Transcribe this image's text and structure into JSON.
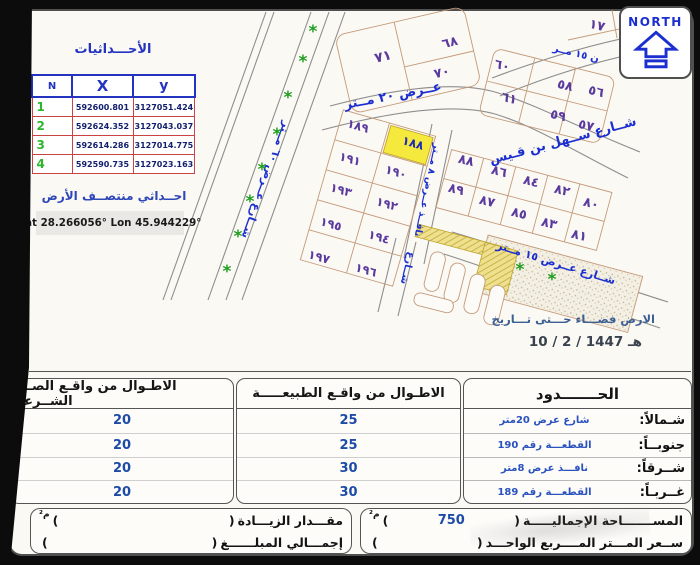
{
  "colors": {
    "accent_blue": "#1b2fd0",
    "plot_purple": "#5b3a9e",
    "highlight_yellow": "#f6e93d",
    "tree_green": "#1f9e1f",
    "table_red_border": "#c94343",
    "table_blue_border": "#2434c0",
    "value_navy": "#1d4ba6"
  },
  "north": {
    "label": "NORTH"
  },
  "coordinates": {
    "title": "الأحـــداثيات",
    "headers": {
      "n": "N",
      "x": "X",
      "y": "y"
    },
    "rows": [
      [
        "1",
        "592600.801",
        "3127051.424"
      ],
      [
        "2",
        "592624.352",
        "3127043.037"
      ],
      [
        "3",
        "592614.286",
        "3127014.775"
      ],
      [
        "4",
        "592590.735",
        "3127023.163"
      ]
    ],
    "center_title": "احــداثي منتصــف الأرض",
    "center_value": "Lat 28.266056°  Lon 45.944229°"
  },
  "map": {
    "note_line1": "الارض فضـــاء حـــتى تـــاريخ",
    "note_line2": "10 /  2  / 1447 هـ",
    "highlighted_plot": "١٨٨",
    "plots": [
      {
        "label": "٧١",
        "x": 383,
        "y": 57,
        "rot": -13,
        "fs": 14
      },
      {
        "label": "٦٨",
        "x": 450,
        "y": 43,
        "rot": -13,
        "fs": 13
      },
      {
        "label": "٧٠",
        "x": 442,
        "y": 73,
        "rot": -13,
        "fs": 13
      },
      {
        "label": "١٧",
        "x": 597,
        "y": 26,
        "rot": 14,
        "fs": 13
      },
      {
        "label": "٦٠",
        "x": 502,
        "y": 66,
        "rot": 14,
        "fs": 13
      },
      {
        "label": "٥٨",
        "x": 565,
        "y": 86,
        "rot": 14,
        "fs": 13
      },
      {
        "label": "٥٦",
        "x": 596,
        "y": 92,
        "rot": 14,
        "fs": 13
      },
      {
        "label": "٦١",
        "x": 509,
        "y": 99,
        "rot": 14,
        "fs": 13
      },
      {
        "label": "٥٩",
        "x": 558,
        "y": 116,
        "rot": 14,
        "fs": 13
      },
      {
        "label": "٥٧",
        "x": 586,
        "y": 126,
        "rot": 14,
        "fs": 13
      },
      {
        "label": "١٨٩",
        "x": 358,
        "y": 126,
        "rot": 16,
        "fs": 12
      },
      {
        "label": "١٨٨",
        "x": 413,
        "y": 143,
        "rot": 16,
        "fs": 12,
        "highlight": true
      },
      {
        "label": "١٩١",
        "x": 350,
        "y": 159,
        "rot": 16,
        "fs": 12
      },
      {
        "label": "١٩٠",
        "x": 396,
        "y": 172,
        "rot": 16,
        "fs": 12
      },
      {
        "label": "١٩٣",
        "x": 341,
        "y": 190,
        "rot": 16,
        "fs": 12
      },
      {
        "label": "١٩٢",
        "x": 387,
        "y": 204,
        "rot": 16,
        "fs": 12
      },
      {
        "label": "١٩٥",
        "x": 331,
        "y": 224,
        "rot": 16,
        "fs": 12
      },
      {
        "label": "١٩٤",
        "x": 379,
        "y": 237,
        "rot": 16,
        "fs": 12
      },
      {
        "label": "١٩٧",
        "x": 319,
        "y": 257,
        "rot": 16,
        "fs": 12
      },
      {
        "label": "١٩٦",
        "x": 366,
        "y": 270,
        "rot": 16,
        "fs": 12
      },
      {
        "label": "٨٨",
        "x": 466,
        "y": 161,
        "rot": 14,
        "fs": 13
      },
      {
        "label": "٨٦",
        "x": 499,
        "y": 172,
        "rot": 14,
        "fs": 13
      },
      {
        "label": "٨٤",
        "x": 531,
        "y": 182,
        "rot": 14,
        "fs": 13
      },
      {
        "label": "٨٢",
        "x": 562,
        "y": 191,
        "rot": 14,
        "fs": 13
      },
      {
        "label": "٨٠",
        "x": 591,
        "y": 204,
        "rot": 14,
        "fs": 13
      },
      {
        "label": "٨٩",
        "x": 456,
        "y": 190,
        "rot": 14,
        "fs": 13
      },
      {
        "label": "٨٧",
        "x": 487,
        "y": 202,
        "rot": 14,
        "fs": 13
      },
      {
        "label": "٨٥",
        "x": 519,
        "y": 214,
        "rot": 14,
        "fs": 13
      },
      {
        "label": "٨٣",
        "x": 549,
        "y": 224,
        "rot": 14,
        "fs": 13
      },
      {
        "label": "٨١",
        "x": 579,
        "y": 236,
        "rot": 14,
        "fs": 13
      }
    ],
    "streets": [
      {
        "label": "شــارع ســهل بن قـيس",
        "x": 563,
        "y": 141,
        "rot": -15,
        "fs": 13
      },
      {
        "label": "عــرض ٢٠ مــتر",
        "x": 393,
        "y": 96,
        "rot": -11,
        "fs": 13
      },
      {
        "label": "شــارع عــرض ٦٠ مــتر",
        "x": 266,
        "y": 180,
        "rot": 110,
        "fs": 11
      },
      {
        "label": "نافــذ عــرض ٨ مــتر",
        "x": 427,
        "y": 190,
        "rot": 102,
        "fs": 9.5
      },
      {
        "label": "شــارع",
        "x": 407,
        "y": 268,
        "rot": 104,
        "fs": 10
      },
      {
        "label": "شــارع عــرض ١٥ مــتر",
        "x": 556,
        "y": 263,
        "rot": 17,
        "fs": 11
      },
      {
        "label": "ن ١٥ مــر",
        "x": 576,
        "y": 54,
        "rot": 14,
        "fs": 10
      }
    ],
    "trees": [
      [
        313,
        32
      ],
      [
        303,
        62
      ],
      [
        288,
        98
      ],
      [
        277,
        135
      ],
      [
        262,
        170
      ],
      [
        250,
        202
      ],
      [
        238,
        237
      ],
      [
        227,
        272
      ],
      [
        520,
        270
      ],
      [
        552,
        280
      ]
    ]
  },
  "tables": {
    "deed": {
      "title": "الاطـوال من واقـع الصــك الشــرعي",
      "values": [
        "20",
        "20",
        "20",
        "20"
      ]
    },
    "nature": {
      "title": "الاطـوال من واقـع الطبيعـــــة",
      "values": [
        "25",
        "25",
        "30",
        "30"
      ]
    },
    "boundaries": {
      "title": "الحـــــــدود",
      "rows": [
        {
          "label": "شـمالاً:",
          "value": "شارع عرض 20متر"
        },
        {
          "label": "جنوبــاً:",
          "value": "القطعـــة رقم 190"
        },
        {
          "label": "شــرقاً:",
          "value": "نافـــذ عرض 8متر"
        },
        {
          "label": "غــربـاً:",
          "value": "القطعـــة رقم 189"
        }
      ]
    }
  },
  "summary": {
    "paren_open": "(",
    "paren_close": ")",
    "area_label": "المســـــــاحة الإجماليـــــة",
    "area_value": "750",
    "area_unit": "م²",
    "price_label": "ســعر المـــتر المــــربع الواحـــد",
    "increase_label": "مقـــدار الزيـــادة",
    "increase_unit": "م²",
    "total_label": "إجمـــالي المبلــــــغ"
  }
}
